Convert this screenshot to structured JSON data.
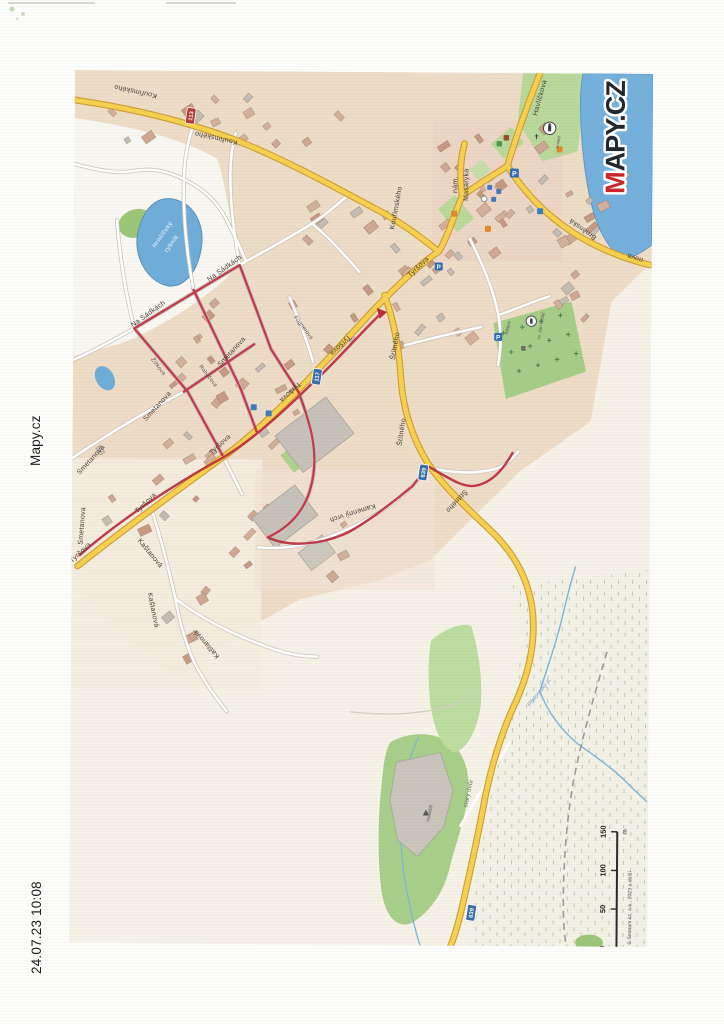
{
  "page": {
    "timestamp": "24.07.23 10:08",
    "site_label": "Mapy.cz"
  },
  "logo": {
    "first_letter": "M",
    "rest": "APY.CZ"
  },
  "map": {
    "street_labels": [
      "Kouřimského",
      "Kouřimského",
      "Kouřimského",
      "Na Sádkách",
      "Na Sádkách",
      "Smetanova",
      "Smetanova",
      "Smetanova",
      "Smetanova",
      "Tyršova",
      "Tyršova",
      "Tyršova",
      "Tyršova",
      "Tyršova",
      "Tyršova",
      "Štítného",
      "Štítného",
      "Štítného",
      "Kamenný vrch",
      "Kaštanová",
      "Kaštanová",
      "Kaštanová",
      "Havlíčkova",
      "Žižkova",
      "Roháčova",
      "Fügnerova",
      "nám.",
      "Masaryka",
      "Brněnská",
      "nova"
    ],
    "place_labels": [
      "starý dvůr",
      "Hradiště",
      "hřbitov",
      "sv. Jan Křtitel",
      "kostel"
    ],
    "water_labels": [
      "Hrnčířský",
      "rybník",
      "Přelomský p."
    ],
    "road_shields": [
      "113",
      "117",
      "639",
      "639"
    ],
    "icons": {
      "parking_glyph": "P",
      "cross_glyph": "✝"
    },
    "scale": {
      "ticks": [
        "0",
        "50",
        "100",
        "150"
      ],
      "unit": "m",
      "attribution": "© Seznam.cz, a.s., 2023 a další"
    }
  }
}
